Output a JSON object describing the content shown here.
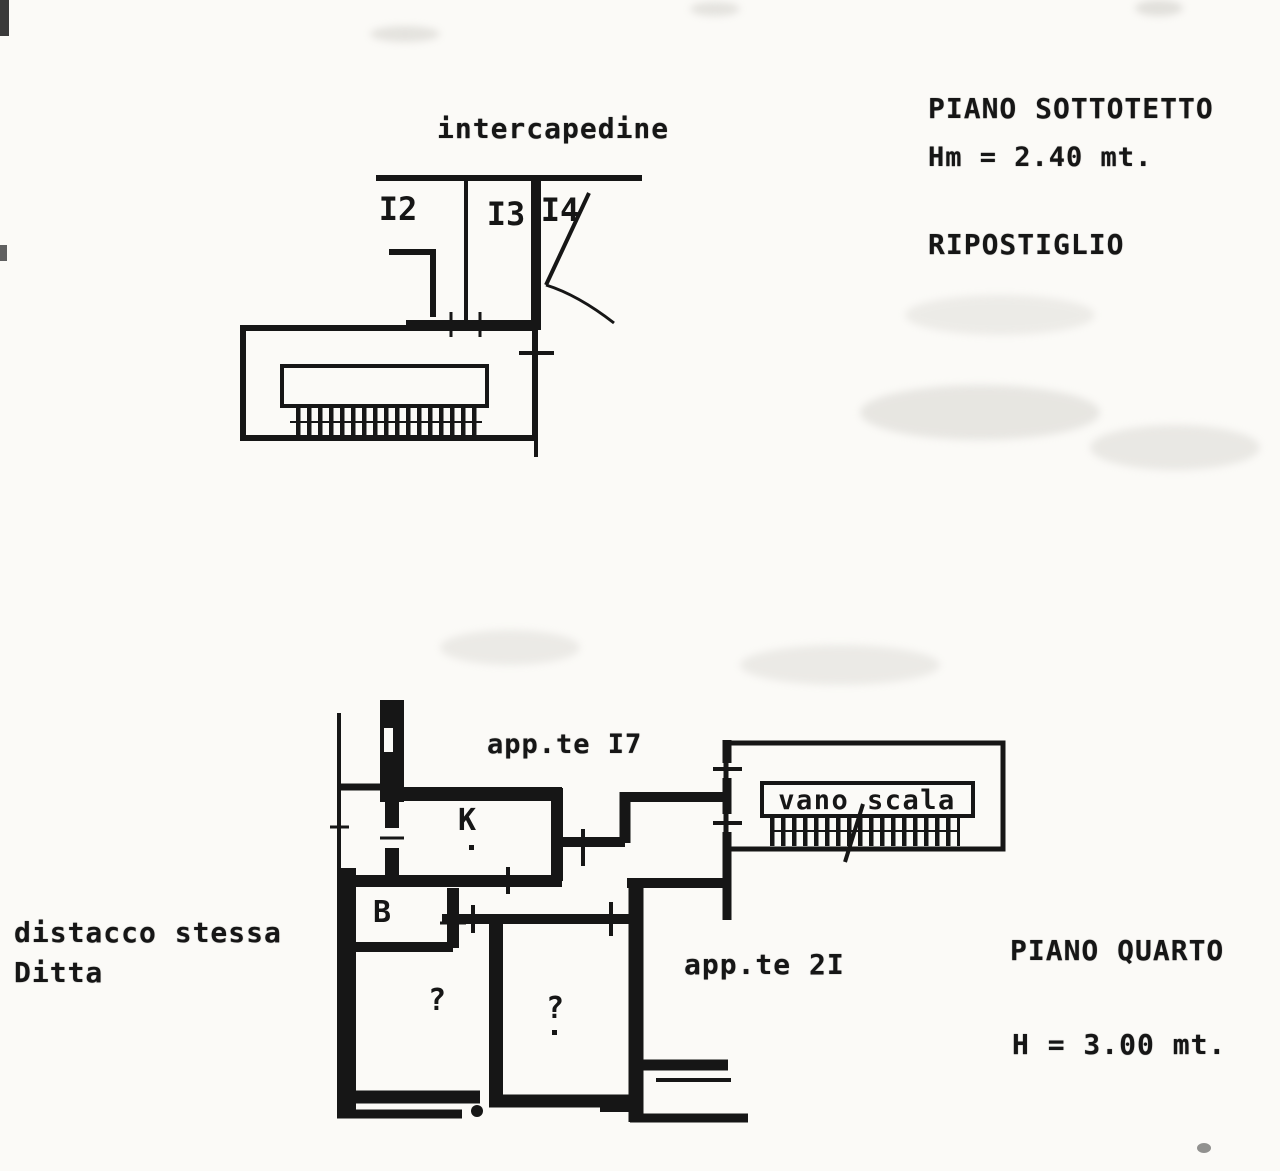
{
  "page": {
    "background": "#fbfaf7",
    "ink": "#161616"
  },
  "upper": {
    "note": "intercapedine",
    "floor_label": "PIANO SOTTOTETTO",
    "height_label": "Hm = 2.40 mt.",
    "room_label": "RIPOSTIGLIO",
    "compartments": [
      "I2",
      "I3",
      "I4"
    ],
    "stairwell_label": "vano scala"
  },
  "lower": {
    "apartment_17_label": "app.te I7",
    "apartment_21_label": "app.te 2I",
    "floor_label": "PIANO QUARTO",
    "height_label": "H = 3.00 mt.",
    "margin_note_line1": "distacco stessa",
    "margin_note_line2": "Ditta",
    "stairwell_label": "vano scala",
    "rooms": {
      "kitchen": "K",
      "bathroom": "B",
      "unknown1": "?",
      "unknown2": "?"
    }
  }
}
